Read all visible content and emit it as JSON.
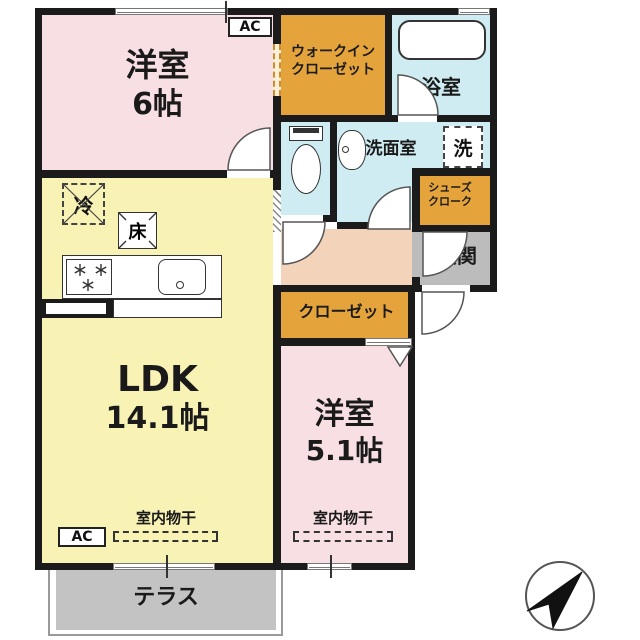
{
  "colors": {
    "wall": "#1b1b1b",
    "room-pink": "#f8dfe3",
    "room-yellow": "#f8f2b4",
    "room-orange": "#e5a43b",
    "room-blue": "#cfecf2",
    "hallway-peach": "#f3d4ba",
    "gray-area": "#bcbcbc",
    "terrace-gray": "#c3c3c3",
    "accent-dashed": "#d08b2d"
  },
  "rooms": {
    "bedroom6": {
      "name": "洋室",
      "size": "6帖"
    },
    "wic": {
      "line1": "ウォークイン",
      "line2": "クローゼット"
    },
    "bath": {
      "name": "浴室"
    },
    "washroom": {
      "name": "洗面室"
    },
    "shoe_cloak": {
      "line1": "シューズ",
      "line2": "クローク"
    },
    "genkan": {
      "name": "玄関"
    },
    "closet": {
      "name": "クローゼット"
    },
    "bedroom51": {
      "name": "洋室",
      "size": "5.1帖"
    },
    "ldk": {
      "name": "LDK",
      "size": "14.1帖"
    },
    "terrace": {
      "name": "テラス"
    }
  },
  "fixtures": {
    "ac": "AC",
    "fridge": "冷",
    "floor_storage": "床",
    "washer": "洗",
    "indoor_drying": "室内物干"
  }
}
